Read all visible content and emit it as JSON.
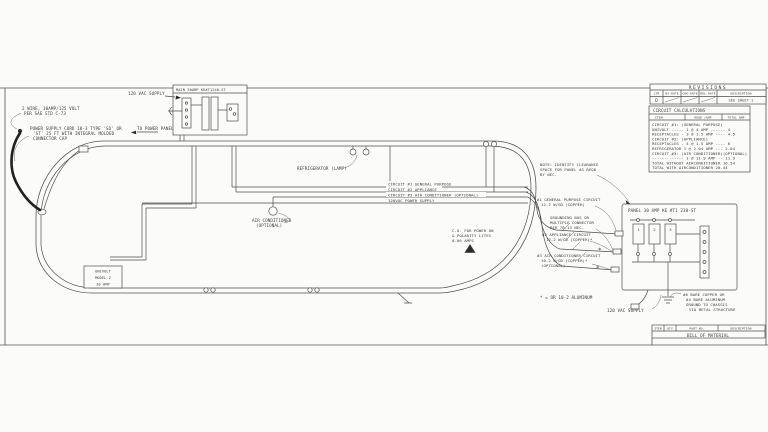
{
  "sheet": {
    "revisions": {
      "title": "REVISIONS",
      "headers": [
        "LTR",
        "BY-DATE",
        "CHK-DATE",
        "REL-DATE",
        "DESCRIPTION"
      ],
      "row": {
        "ltr": "D",
        "description": "SEE SHEET 1"
      }
    },
    "calc": {
      "title": "CIRCUIT CALCULATIONS",
      "headers": [
        "ITEM",
        "REQD /AMP",
        "TOTAL AMP"
      ],
      "rows": [
        "CIRCUIT #1: (GENERAL PURPOSE)",
        "UNIVOLT ----- 1 @ 4 AMP ------ 4",
        "RECEPTACLES - 3 @ 1.5 AMP ---- 4.5",
        "CIRCUIT #2: (APPLIANCE)",
        "RECEPTACLES - 4 @ 1.5 AMP ---- 6",
        "REFRIGERATOR  1 @ 2.04 AMP --- 2.04",
        "CIRCUIT #3: (AIR CONDITIONER)(OPTIONAL)",
        "------------- 1 @ 11.9 AMP -- 11.9",
        "TOTAL WITHOUT AIRCONDITIONER    16.54",
        "TOTAL WITH AIRCONDITIONER       28.44"
      ]
    },
    "bom": {
      "headers": [
        "ITEM",
        "QTY",
        "PART NO.",
        "DESCRIPTION"
      ],
      "title": "BILL OF MATERIAL"
    }
  },
  "labels": {
    "wire_spec": [
      "2 WIRE, 30AMP/125 VOLT",
      "PER SAE STD C-73"
    ],
    "cord": [
      "POWER SUPPLY CORD 10-3 TYPE 'SO' OR",
      "'ST' 25 FT WITH INTEGRAL MOLDED",
      "CONNECTOR CAP"
    ],
    "vac_supply_top": "120 VAC SUPPLY",
    "to_power_panel": "TO POWER PANEL",
    "main_breaker": "MAIN 30AMP KE#T1240-ST",
    "refrigerator": "REFRIGERATOR (LAMP)",
    "runs": [
      "CIRCUIT #1 GENERAL PURPOSE",
      "CIRCUIT #2 APPLIANCE",
      "CIRCUIT #3 AIR CONDITIONER (OPTIONAL)",
      "120VAC POWER SUPPLY"
    ],
    "air_cond": [
      "AIR CONDITIONER",
      "(OPTIONAL)"
    ],
    "univolt": [
      "UNIVOLT",
      "MODEL 2",
      "30 AMP"
    ],
    "co_polarity": [
      "C.O. FOR POWER ON",
      "& POLARITY LITES",
      "0.06 AMPS"
    ],
    "nec_note": [
      "NOTE: IDENTIFY CLEARANCE",
      "SPACE FOR PANEL AS REQD",
      "BY NEC."
    ],
    "c1_panel": [
      "#1 GENERAL PURPOSE CIRCUIT",
      "12-2 W/GD (COPPER)"
    ],
    "ground_bus": [
      "GROUNDING BUS OR",
      "MULTIPLE CONNECTOR",
      "PER 70-13 NEC."
    ],
    "c2_panel": [
      "#2 APPLIANCE CIRCUIT",
      "12-2 W/GD (COPPER)*"
    ],
    "c3_panel": [
      "#3 AIR CONDITIONER CIRCUIT",
      "10-2 W/GD (COPPER)*",
      "(OPTIONAL)"
    ],
    "panel_title": "PANEL  30 AMP  KE #T1 230-ST",
    "breakers": [
      "1",
      "2",
      "3"
    ],
    "ground_note": [
      "#6 BARE COPPER OR",
      "#4 BARE ALUMINUM",
      "GROUND TO CHASSIS",
      "VIA METAL STRUCTURE"
    ],
    "vac_supply_bottom": "120 VAC SUPPLY",
    "aluminum_note": "* = OR 10-2 ALUMINUM",
    "star": "*"
  }
}
